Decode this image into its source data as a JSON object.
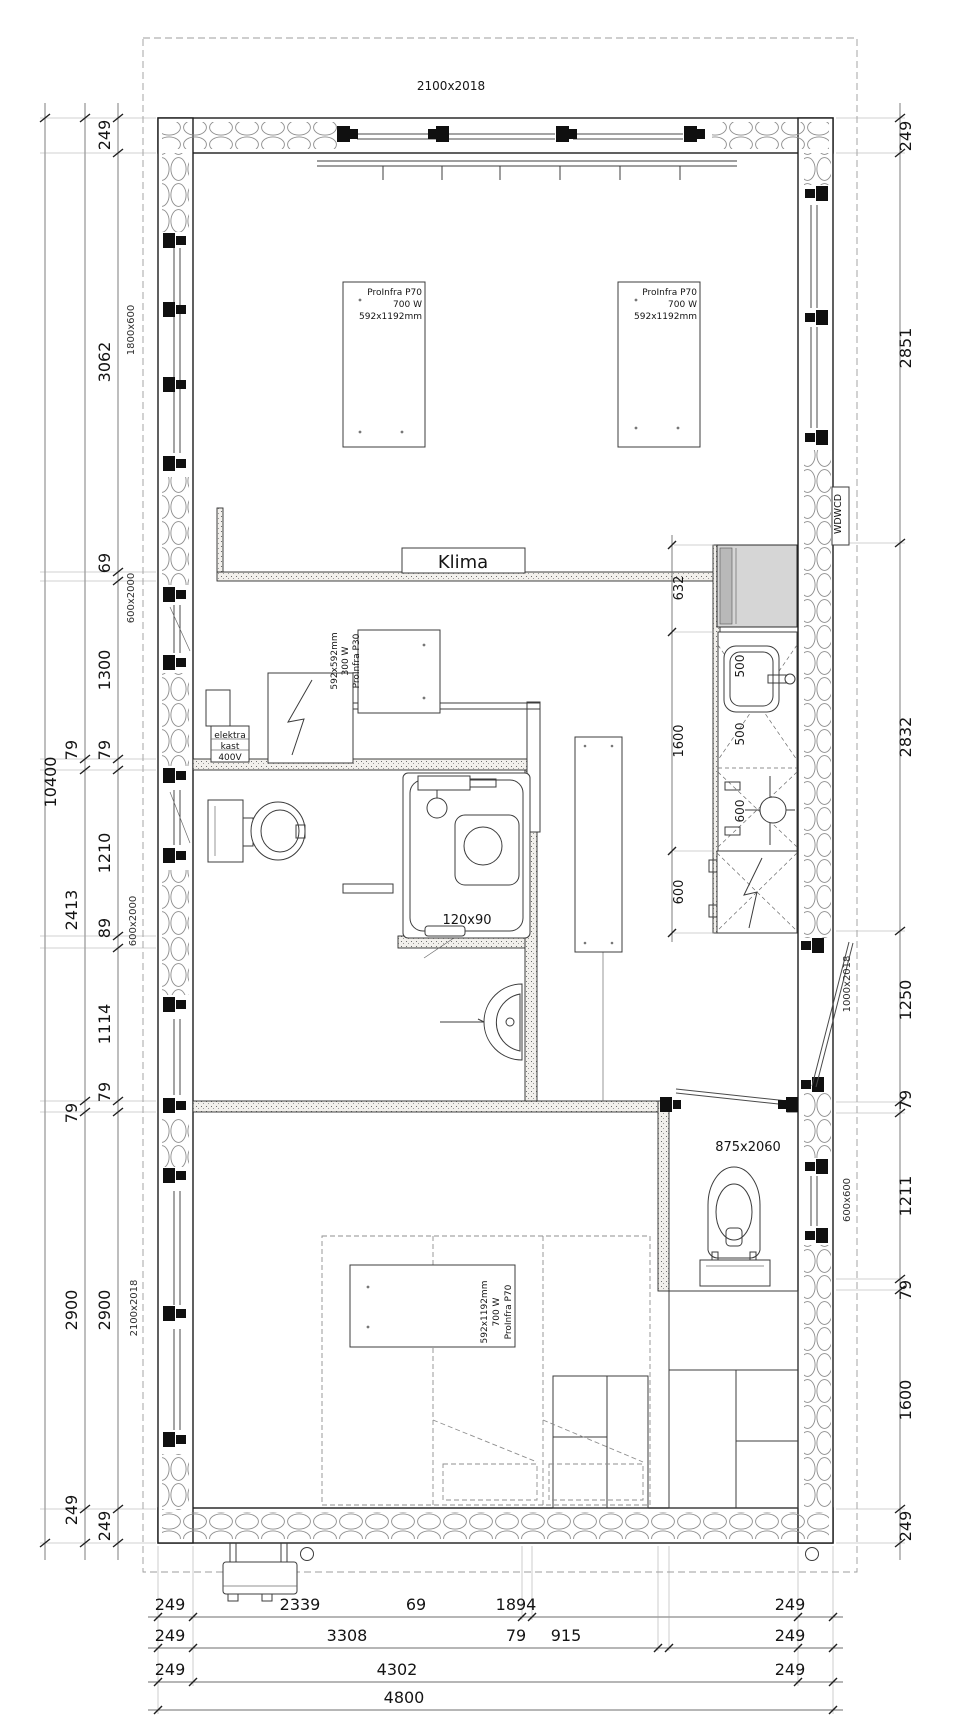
{
  "drawing": {
    "type": "floor-plan",
    "units": "mm",
    "overall_width": "4800",
    "overall_height": "10400"
  },
  "dims": {
    "l1": [
      "249",
      "3062",
      "69",
      "1300",
      "79",
      "1210",
      "89",
      "1114",
      "79",
      "2900",
      "249"
    ],
    "l2": [
      "79",
      "2413",
      "79",
      "2900",
      "249"
    ],
    "l3": [
      "10400"
    ],
    "r": [
      "249",
      "2851",
      "2832",
      "1250",
      "79",
      "1211",
      "79",
      "1600",
      "249"
    ],
    "b1": [
      "249",
      "2339",
      "69",
      "1894",
      "249"
    ],
    "b2": [
      "249",
      "3308",
      "79",
      "915",
      "249"
    ],
    "b3": [
      "249",
      "4302",
      "249"
    ],
    "b4": [
      "4800"
    ],
    "k": [
      "632",
      "1600",
      "600"
    ],
    "ki": [
      "500",
      "500",
      "600"
    ]
  },
  "wall_labels": {
    "top": "2100x2018",
    "left": [
      "1800x600",
      "600x2000",
      "600x2000",
      "2100x2018"
    ],
    "right": [
      "1000x2018",
      "600x600"
    ]
  },
  "rooms": {
    "klima": "Klima",
    "wdwcd": "WDWCD",
    "elektra": [
      "elektra",
      "kast",
      "400V"
    ],
    "shower": "120x90",
    "wc_door": "875x2060"
  },
  "panels": {
    "p70": [
      "ProInfra P70",
      "700 W",
      "592x1192mm"
    ],
    "p30": [
      "ProInfra P30",
      "300 W",
      "592x592mm"
    ]
  }
}
